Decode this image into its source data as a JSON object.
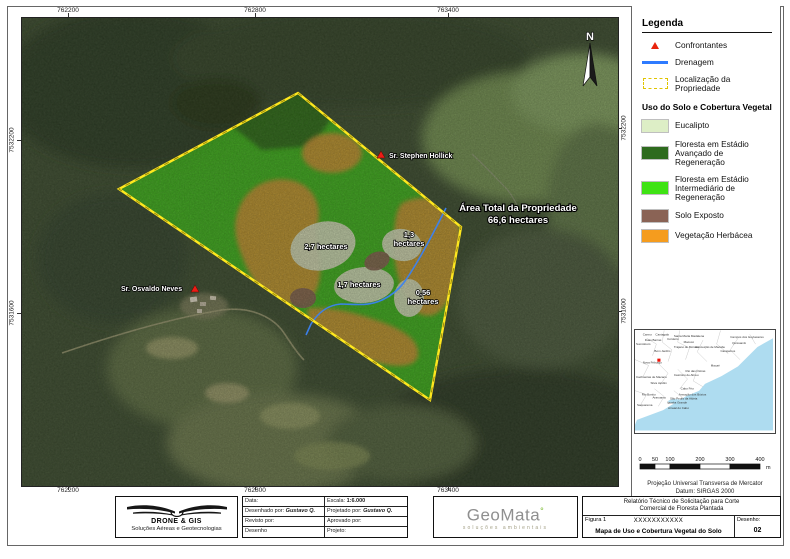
{
  "map": {
    "top_coords": [
      "762200",
      "762800",
      "763400"
    ],
    "bottom_coords": [
      "762200",
      "762800",
      "763400"
    ],
    "left_coords": [
      "7532200",
      "7531600"
    ],
    "right_coords": [
      "7532200",
      "7531600"
    ],
    "north_label": "N",
    "annotations": {
      "neighbor_top": "Sr. Stephen Hollick",
      "neighbor_left": "Sr. Osvaldo Neves",
      "area_line1": "Área Total da Propriedade",
      "area_line2": "66,6 hectares",
      "parcel_27": "2,7 hectares",
      "parcel_13a": "1,3",
      "parcel_13b": "hectares",
      "parcel_17": "1,7 hectares",
      "parcel_056a": "0,56",
      "parcel_056b": "hectares"
    }
  },
  "legend": {
    "title": "Legenda",
    "items": [
      {
        "label": "Confrontantes"
      },
      {
        "label": "Drenagem"
      },
      {
        "label": "Localização da Propriedade"
      }
    ],
    "landuse_title": "Uso do Solo e Cobertura Vegetal",
    "landuse": [
      {
        "label": "Eucalipto",
        "color": "#ddeec6"
      },
      {
        "label": "Floresta em Estádio Avançado de Regeneração",
        "color": "#2e6b1e"
      },
      {
        "label": "Floresta em Estádio Intermediário de Regeneração",
        "color": "#3fe314"
      },
      {
        "label": "Solo Exposto",
        "color": "#8a6355"
      },
      {
        "label": "Vegetação Herbácea",
        "color": "#f59c1e"
      }
    ],
    "marker_color": "#e8240c",
    "drainage_color": "#2e7bff",
    "boundary_color": "#f5e400"
  },
  "inset": {
    "dot_color": "#ee1208",
    "ocean_color": "#aedcf0",
    "labels": [
      {
        "t": "Carmo",
        "x": 8,
        "y": 5
      },
      {
        "t": "Cantagalo",
        "x": 21,
        "y": 5
      },
      {
        "t": "Santa Maria Madalena",
        "x": 40,
        "y": 7
      },
      {
        "t": "Campos dos Goytacazes",
        "x": 98,
        "y": 8
      },
      {
        "t": "Duas Barras",
        "x": 10,
        "y": 11
      },
      {
        "t": "Cordeiro",
        "x": 33,
        "y": 10
      },
      {
        "t": "Macuco",
        "x": 50,
        "y": 13
      },
      {
        "t": "Quissamã",
        "x": 100,
        "y": 14
      },
      {
        "t": "Sumidouro",
        "x": 1,
        "y": 15
      },
      {
        "t": "Trajano de Moraes",
        "x": 40,
        "y": 18
      },
      {
        "t": "Conceição de Macabu",
        "x": 62,
        "y": 18
      },
      {
        "t": "Bom Jardim",
        "x": 20,
        "y": 22
      },
      {
        "t": "Carapebus",
        "x": 88,
        "y": 22
      },
      {
        "t": "Nova Friburgo",
        "x": 8,
        "y": 34
      },
      {
        "t": "Macaé",
        "x": 78,
        "y": 37
      },
      {
        "t": "Rio das Ostras",
        "x": 52,
        "y": 43
      },
      {
        "t": "Casimiro de Abreu",
        "x": 40,
        "y": 47
      },
      {
        "t": "Cachoeiras de Macacu",
        "x": 1,
        "y": 49
      },
      {
        "t": "Silva Jardim",
        "x": 16,
        "y": 55
      },
      {
        "t": "Cabo Frio",
        "x": 47,
        "y": 61
      },
      {
        "t": "Rio Bonito",
        "x": 7,
        "y": 67
      },
      {
        "t": "Araruama",
        "x": 18,
        "y": 70
      },
      {
        "t": "Armação dos Búzios",
        "x": 45,
        "y": 67
      },
      {
        "t": "São Pedro da Aldeia",
        "x": 36,
        "y": 71
      },
      {
        "t": "Iguaba Grande",
        "x": 33,
        "y": 75
      },
      {
        "t": "Saquarema",
        "x": 2,
        "y": 78
      },
      {
        "t": "Arraial do Cabo",
        "x": 34,
        "y": 81
      }
    ]
  },
  "scalebar": {
    "ticks": [
      "0",
      "50",
      "100",
      "200",
      "300",
      "400"
    ],
    "unit": "m"
  },
  "projection": {
    "line1": "Projeção Universal Transversa de Mercator",
    "line2": "Datum: SIRGAS 2000"
  },
  "titleblock": {
    "drone": {
      "name": "DRONE & GIS",
      "tagline": "Soluções Aéreas e Geotecnologias"
    },
    "table": {
      "data_label": "Data:",
      "escala_label": "Escala: ",
      "escala_value": "1:6.000",
      "desenhado_label": "Desenhado por:  ",
      "desenhado_value": "Gustavo Q.",
      "projetado_label": "Projetado por:  ",
      "projetado_value": "Gustavo Q.",
      "revisto_label": "Revisto por:",
      "aprovado_label": "Aprovado por:",
      "desenho_label": "Desenho",
      "projeto_label": "Projeto:"
    },
    "geomata": {
      "name": "GeoMata",
      "degree": "°",
      "tagline": "soluções ambientais"
    },
    "report": {
      "line1": "Relatório Técnico de Solicitação para Corte",
      "line2": "Comercial de Floresta Plantada",
      "figura": "Figura 1",
      "code": "XXXXXXXXXXX",
      "map_title": "Mapa de Uso e Cobertura Vegetal do Solo",
      "desenho_label": "Desenho:",
      "desenho_value": "02"
    }
  }
}
